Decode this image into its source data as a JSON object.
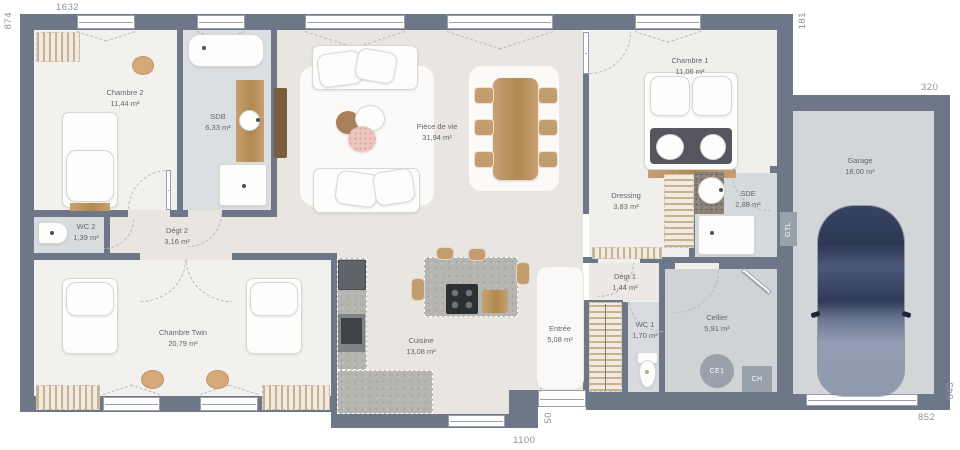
{
  "rooms": [
    {
      "name": "Chambre 2",
      "area": "11,44 m²"
    },
    {
      "name": "SDB",
      "area": "6,33 m²"
    },
    {
      "name": "Pièce de vie",
      "area": "31,94 m²"
    },
    {
      "name": "Chambre 1",
      "area": "11,06 m²"
    },
    {
      "name": "Dressing",
      "area": "3,83 m²"
    },
    {
      "name": "SDE",
      "area": "2,88 m²"
    },
    {
      "name": "Garage",
      "area": "18,00 m²"
    },
    {
      "name": "WC 2",
      "area": "1,39 m²"
    },
    {
      "name": "Dégt 2",
      "area": "3,16 m²"
    },
    {
      "name": "Chambre Twin",
      "area": "20,79 m²"
    },
    {
      "name": "Cuisine",
      "area": "13,08 m²"
    },
    {
      "name": "Entrée",
      "area": "5,08 m²"
    },
    {
      "name": "Dégt 1",
      "area": "1,44 m²"
    },
    {
      "name": "WC 1",
      "area": "1,70 m²"
    },
    {
      "name": "Cellier",
      "area": "5,91 m²"
    }
  ],
  "dimensions": {
    "top": "1632",
    "left": "874",
    "right_upper": "181",
    "garage_top": "320",
    "garage_right": "643",
    "garage_bottom": "852",
    "bottom": "1100",
    "entry": "50"
  },
  "tags": {
    "gtl": "GTL",
    "water_heater": "CE1",
    "boiler": "CH"
  },
  "colors": {
    "wall": "#6e7787",
    "floor_bedroom": "#f3f1ed",
    "floor_living": "#e9e5e0",
    "floor_wet": "#d9dcde",
    "floor_cellier": "#cfd3d6",
    "floor_garage": "#d3d6d9",
    "wood": "#c49d6f",
    "car_body": "#2e3a5c",
    "label_text": "#60666f",
    "dim_text": "#8e939c"
  }
}
